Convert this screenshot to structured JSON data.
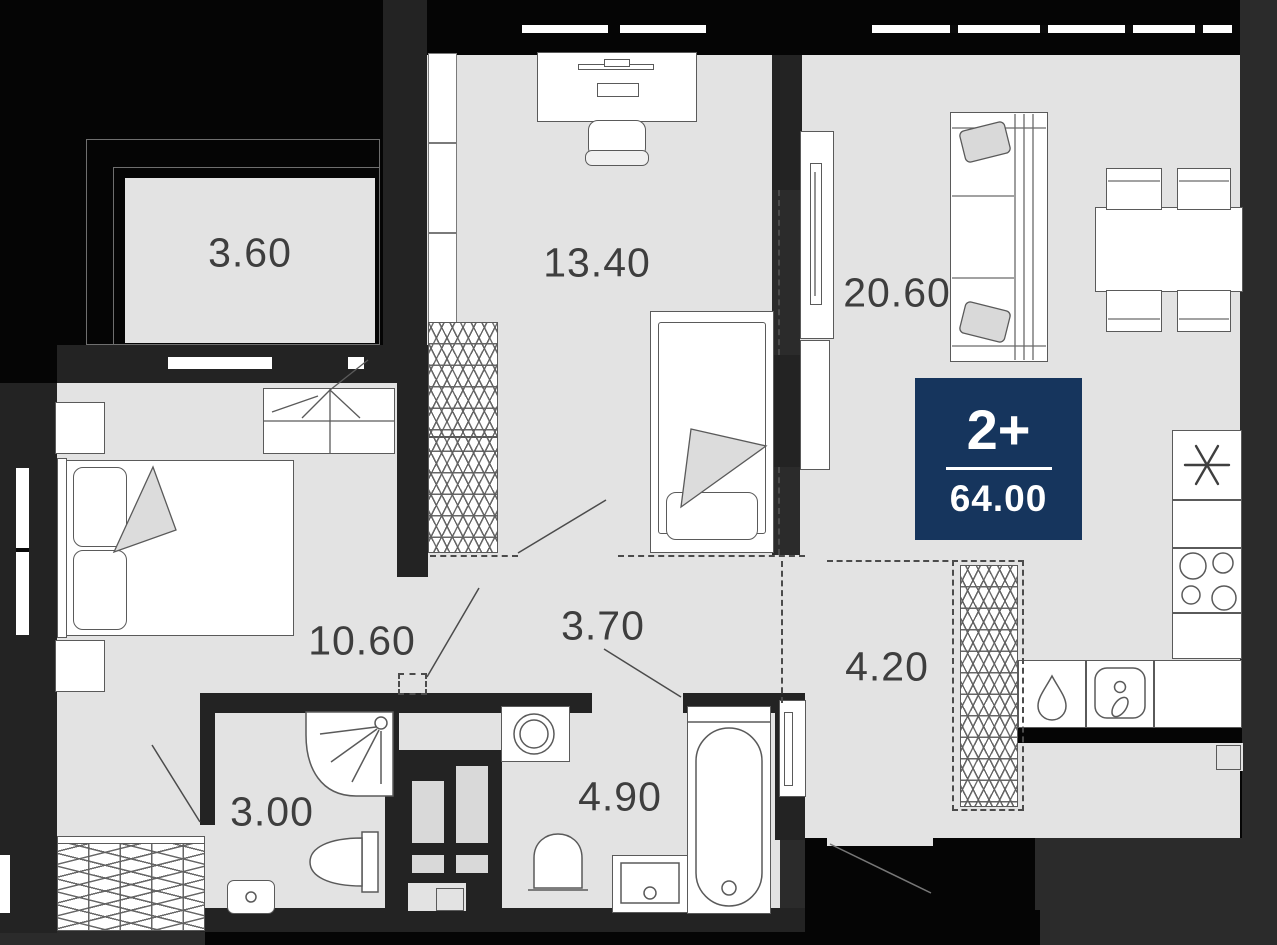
{
  "floor_plan": {
    "type": "apartment-floor-plan",
    "badge": {
      "rooms_count": "2+",
      "total_area": "64.00",
      "bg_color": "#16355d",
      "text_color": "#ffffff"
    },
    "rooms": {
      "balcony": {
        "label": "3.60"
      },
      "bedroom": {
        "label": "13.40"
      },
      "living_kitchen": {
        "label": "20.60"
      },
      "master_bedroom": {
        "label": "10.60"
      },
      "hall": {
        "label": "3.70"
      },
      "corridor": {
        "label": "4.20"
      },
      "shower_room": {
        "label": "3.00"
      },
      "bathroom": {
        "label": "4.90"
      }
    },
    "icons": {
      "fridge": "six-spoke-asterisk",
      "stove": "four-burner-circles",
      "sink": "rounded-square-with-faucet",
      "shower": "quarter-round-tray-with-sprayer",
      "washer": "concentric-door-circles",
      "wardrobe": "zigzag-hatch"
    },
    "colors": {
      "floor": "#e3e3e3",
      "walls": "#232323",
      "exterior": "#050505",
      "background": "#2b2b2b",
      "furniture_fill": "#ffffff",
      "furniture_stroke": "#5a5a5a",
      "label_text": "#3e3e3e",
      "badge_bg": "#16355d"
    }
  }
}
